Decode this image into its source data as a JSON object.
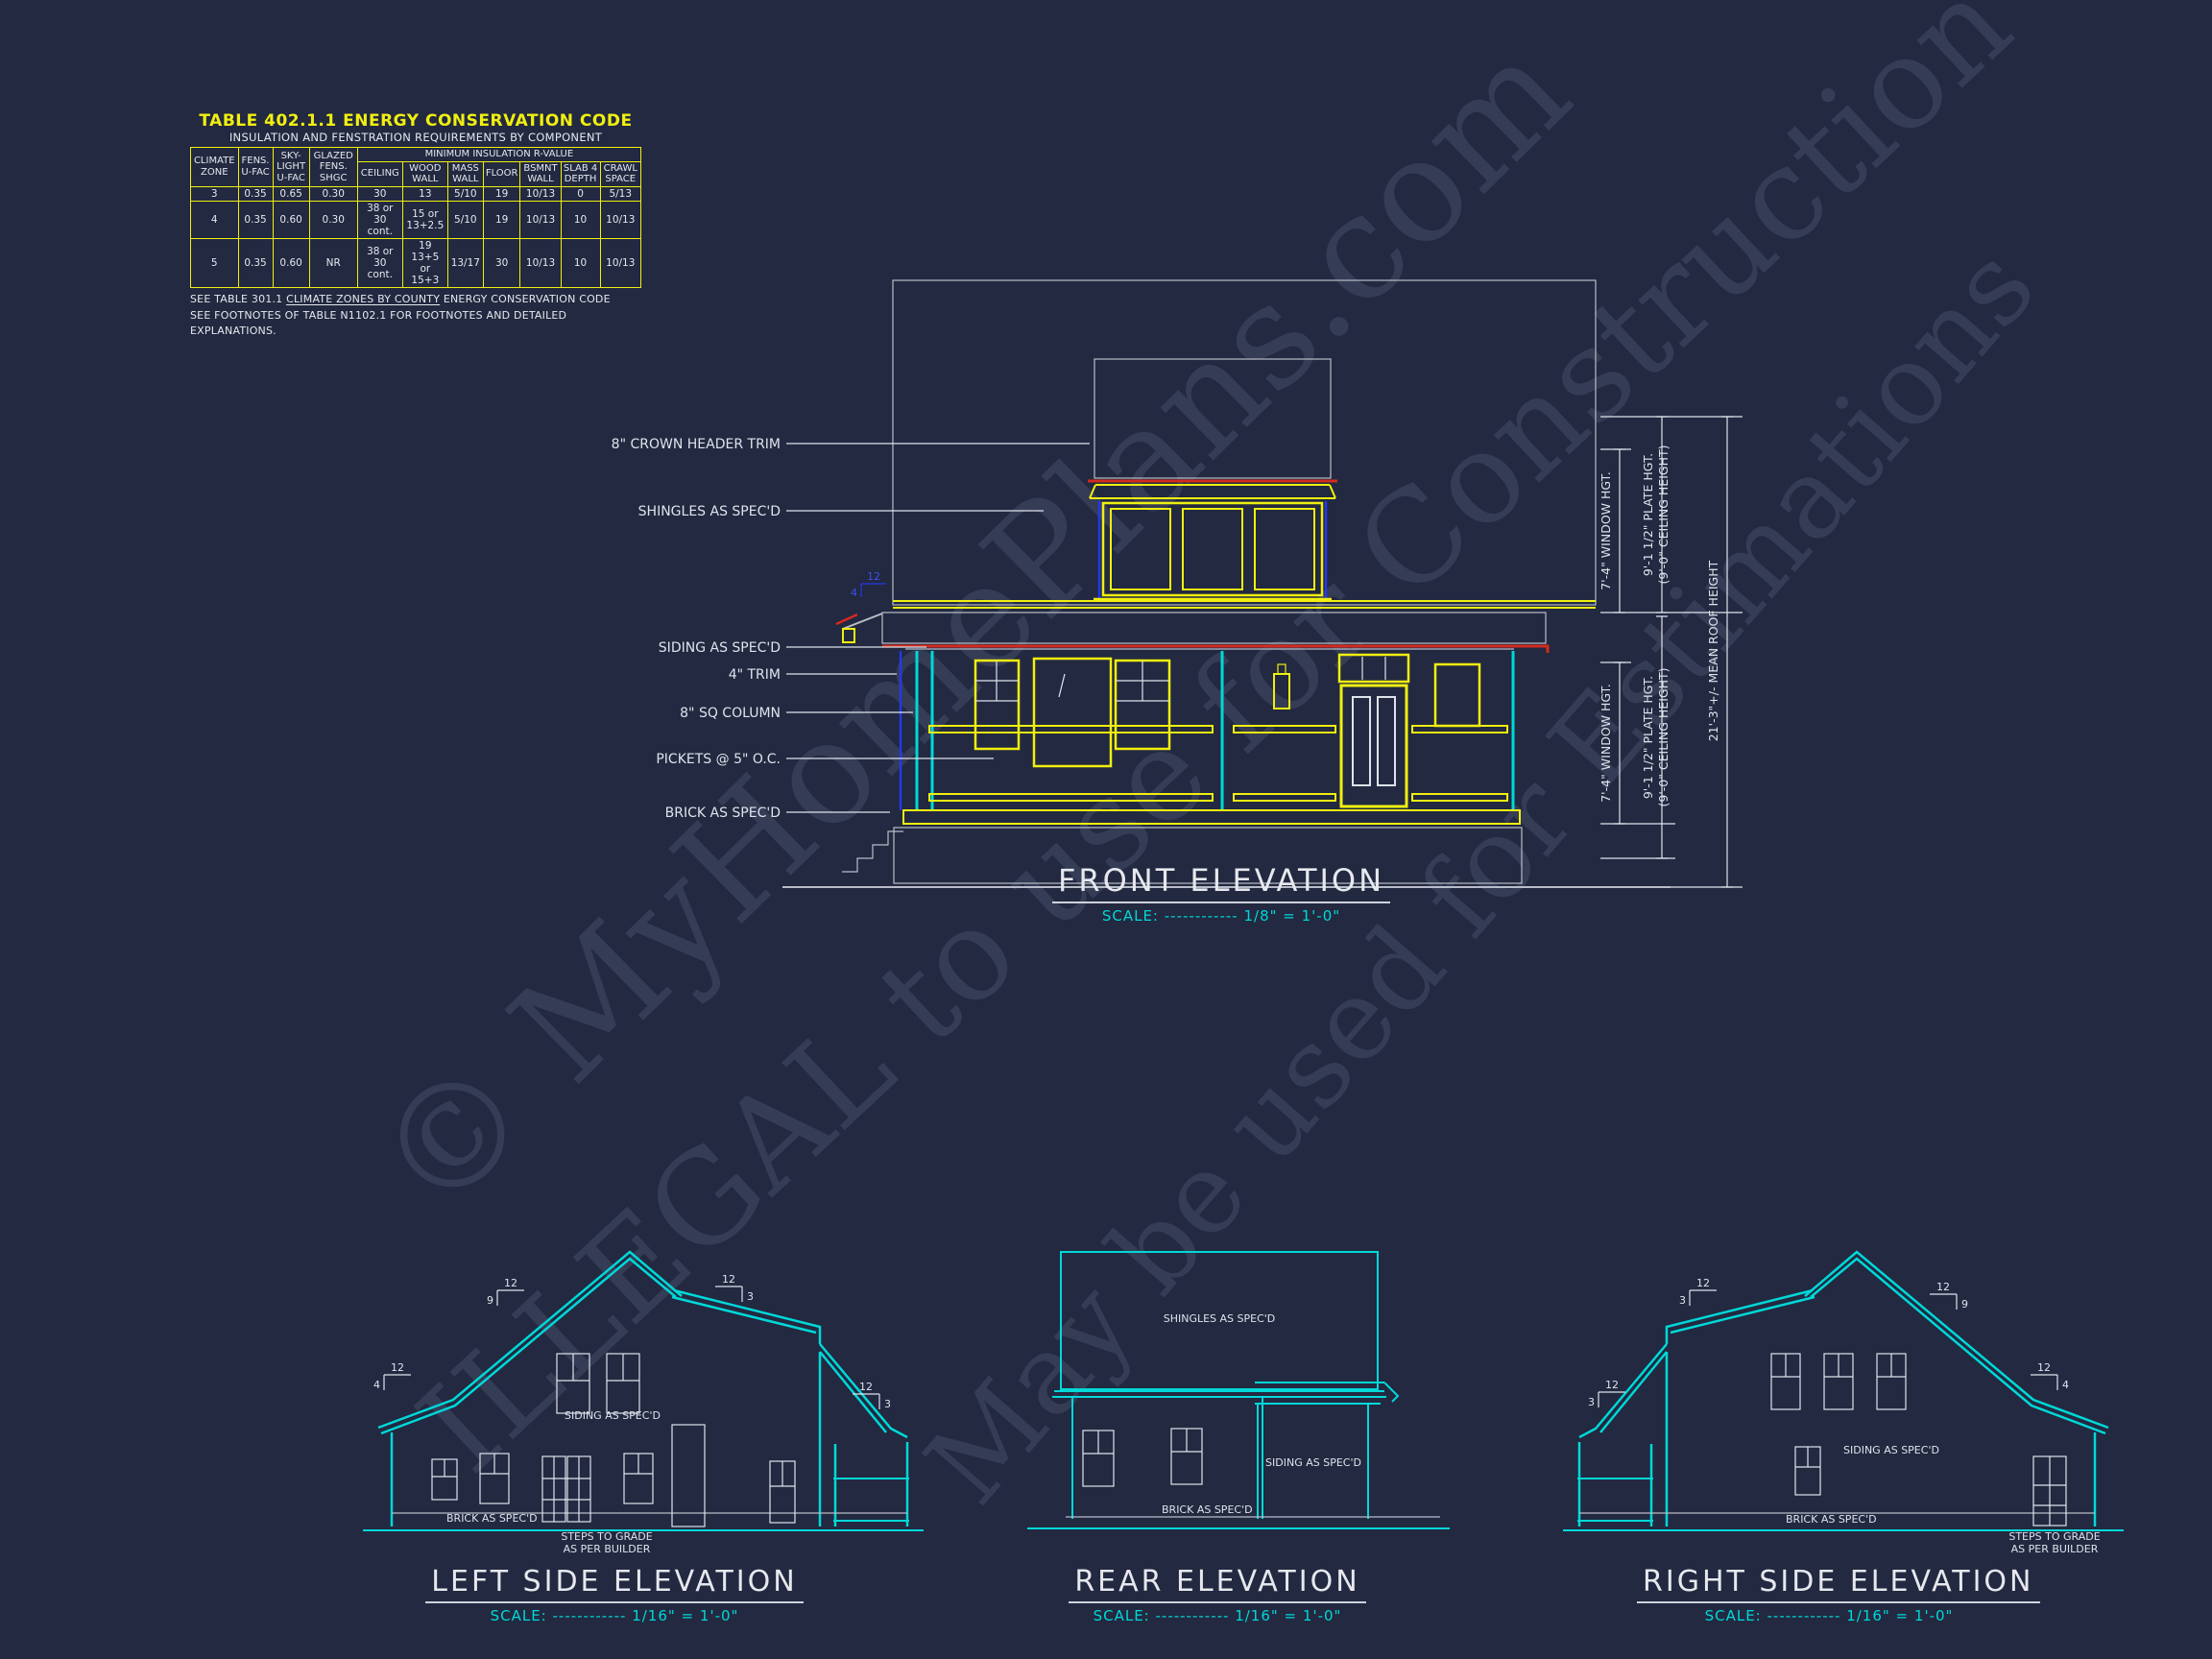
{
  "sheet": {
    "background": "#222940",
    "accent_yellow": "#f0ef10",
    "accent_cyan": "#00d8d8",
    "accent_red": "#d42a1e",
    "accent_blue": "#2438e8",
    "line_white": "#e6e8ee"
  },
  "watermark": {
    "line1": "© MyHomePlans.com",
    "line2": "ILLEGAL to use for Construction",
    "line3": "May be used for Estimations"
  },
  "energy_table": {
    "title": "TABLE 402.1.1 ENERGY CONSERVATION CODE",
    "subtitle": "INSULATION AND FENSTRATION REQUIREMENTS BY COMPONENT",
    "span_header": "MINIMUM INSULATION R-VALUE",
    "columns": [
      "CLIMATE ZONE",
      "FENS. U-FAC",
      "SKY-LIGHT U-FAC",
      "GLAZED FENS. SHGC",
      "CEILING",
      "WOOD WALL",
      "MASS WALL",
      "FLOOR",
      "BSMNT WALL",
      "SLAB 4 DEPTH",
      "CRAWL SPACE"
    ],
    "rows": [
      [
        "3",
        "0.35",
        "0.65",
        "0.30",
        "30",
        "13",
        "5/10",
        "19",
        "10/13",
        "0",
        "5/13"
      ],
      [
        "4",
        "0.35",
        "0.60",
        "0.30",
        "38 or 30 cont.",
        "15 or 13+2.5",
        "5/10",
        "19",
        "10/13",
        "10",
        "10/13"
      ],
      [
        "5",
        "0.35",
        "0.60",
        "NR",
        "38 or 30 cont.",
        "19 13+5 or 15+3",
        "13/17",
        "30",
        "10/13",
        "10",
        "10/13"
      ]
    ],
    "note1_pre": "SEE TABLE 301.1 ",
    "note1_underlined": "CLIMATE ZONES BY COUNTY",
    "note1_post": " ENERGY CONSERVATION CODE",
    "note2": "SEE FOOTNOTES OF TABLE N1102.1 FOR FOOTNOTES AND DETAILED EXPLANATIONS."
  },
  "front": {
    "title": "FRONT ELEVATION",
    "scale": "SCALE: ------------ 1/8\" = 1'-0\"",
    "labels": {
      "crown": "8\" CROWN HEADER TRIM",
      "shingles": "SHINGLES AS SPEC'D",
      "siding": "SIDING AS SPEC'D",
      "trim": "4\" TRIM",
      "column": "8\" SQ COLUMN",
      "pickets": "PICKETS @ 5\" O.C.",
      "brick": "BRICK AS SPEC'D"
    },
    "dims": {
      "window_upper": "7'-4\" WINDOW HGT.",
      "window_lower": "7'-4\" WINDOW HGT.",
      "plate_upper": "9'-1 1/2\" PLATE HGT.",
      "plate_upper2": "(9'-0\" CEILING HEIGHT)",
      "plate_lower": "9'-1 1/2\" PLATE HGT.",
      "plate_lower2": "(9'-0\" CEILING HEIGHT)",
      "mean_roof": "21'-3\"+/- MEAN ROOF HEIGHT"
    },
    "pitch": {
      "run": "12",
      "rise": "4"
    }
  },
  "left_side": {
    "title": "LEFT SIDE ELEVATION",
    "scale": "SCALE: ------------ 1/16\" = 1'-0\"",
    "labels": {
      "siding": "SIDING AS SPEC'D",
      "brick": "BRICK AS SPEC'D",
      "steps1": "STEPS TO GRADE",
      "steps2": "AS PER BUILDER"
    },
    "pitch_markers": [
      {
        "run": "12",
        "rise": "9"
      },
      {
        "run": "12",
        "rise": "4"
      },
      {
        "run": "12",
        "rise": "3"
      },
      {
        "run": "12",
        "rise": "3"
      }
    ]
  },
  "rear": {
    "title": "REAR ELEVATION",
    "scale": "SCALE: ------------ 1/16\" = 1'-0\"",
    "labels": {
      "shingles": "SHINGLES AS SPEC'D",
      "siding": "SIDING AS SPEC'D",
      "brick": "BRICK AS SPEC'D"
    }
  },
  "right_side": {
    "title": "RIGHT SIDE ELEVATION",
    "scale": "SCALE: ------------ 1/16\" = 1'-0\"",
    "labels": {
      "siding": "SIDING AS SPEC'D",
      "brick": "BRICK AS SPEC'D",
      "steps1": "STEPS TO GRADE",
      "steps2": "AS PER BUILDER"
    },
    "pitch_markers": [
      {
        "run": "12",
        "rise": "3"
      },
      {
        "run": "12",
        "rise": "9"
      },
      {
        "run": "12",
        "rise": "4"
      },
      {
        "run": "12",
        "rise": "3"
      }
    ]
  }
}
